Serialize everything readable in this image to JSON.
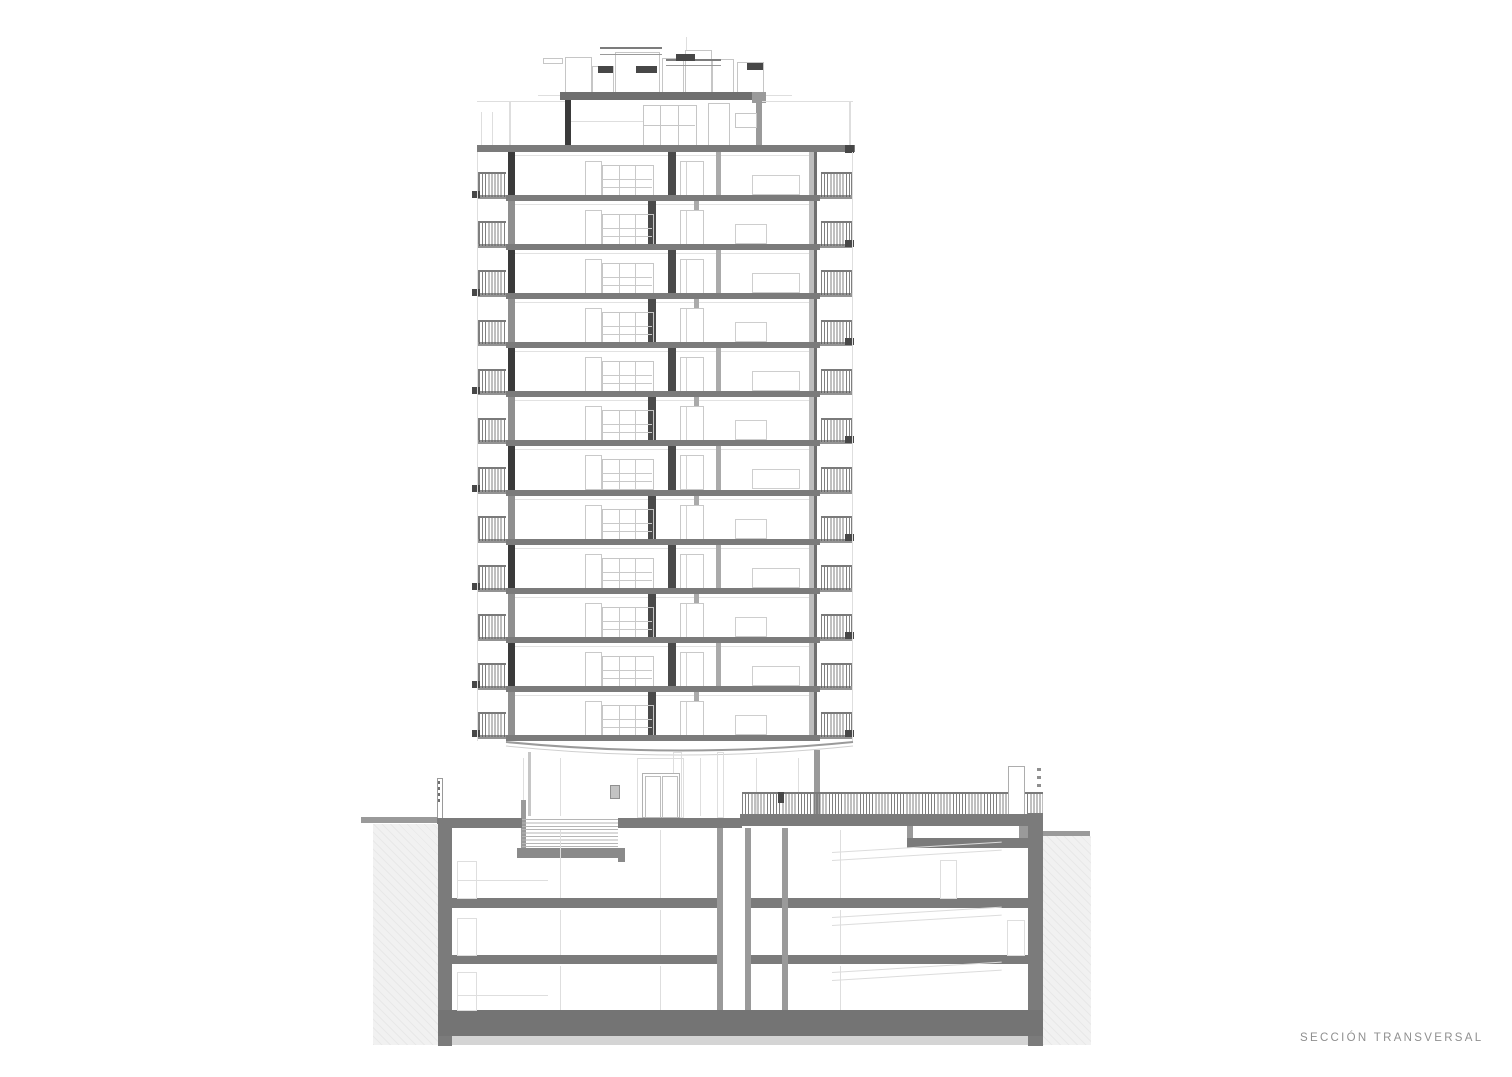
{
  "caption": "SECCIÓN TRANSVERSAL",
  "drawing_type": "architectural cross-section",
  "building": {
    "tower_floors": 12,
    "has_penthouse": true,
    "basement_levels": 3,
    "balconies_per_floor": 2
  },
  "colors": {
    "paper": "#ffffff",
    "slab": "#7b7b7b",
    "slab-dark": "#6f6f6f",
    "wall-dark": "#3a3a3a",
    "wall-mid": "#9a9a9a",
    "wall-core": "#4a4a4a",
    "line-light": "#c6c6c6",
    "line-faint": "#dedede",
    "block-dark": "#474747",
    "earth-fill": "#f1f1f1",
    "caption-text": "#8f8f8f"
  }
}
